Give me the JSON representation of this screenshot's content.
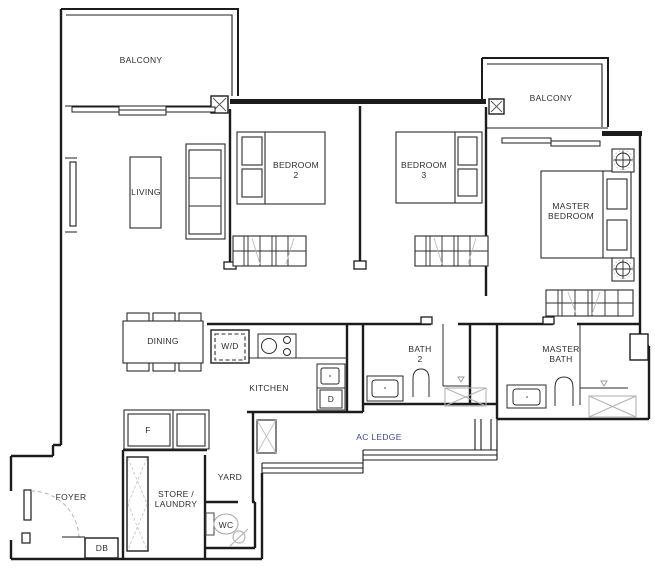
{
  "document": {
    "kind": "apartment-floor-plan"
  },
  "labels": {
    "balcony_1": "BALCONY",
    "living": "LIVING",
    "bedroom_2": "BEDROOM\n2",
    "bedroom_3": "BEDROOM\n3",
    "balcony_2": "BALCONY",
    "master_bedroom": "MASTER\nBEDROOM",
    "dining": "DINING",
    "washer_dryer": "W/D",
    "kitchen": "KITCHEN",
    "dishwasher": "D",
    "bath_2": "BATH\n2",
    "master_bath": "MASTER\nBATH",
    "ac_ledge": "AC LEDGE",
    "fridge": "F",
    "yard": "YARD",
    "foyer": "FOYER",
    "store_laundry": "STORE /\nLAUNDRY",
    "wc": "WC",
    "db": "DB"
  },
  "colors": {
    "background": "#ffffff",
    "wall": "#1c1c1c",
    "furniture": "#2b2b2b",
    "light_gray_detail": "#b3b3b3",
    "label_text": "#2e2e2e",
    "ac_ledge_label": "#3b4a8c"
  }
}
